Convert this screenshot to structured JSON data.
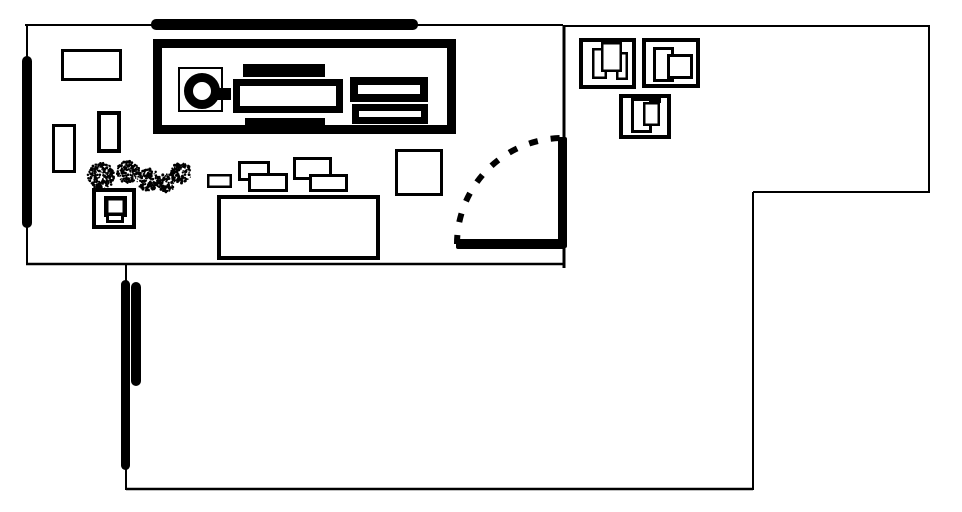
{
  "canvas": {
    "width": 962,
    "height": 512,
    "background": "#ffffff",
    "ink": "#000000"
  },
  "floor_plan": {
    "description": "black-and-white hand-drawn office floor plan",
    "shapes": [
      {
        "type": "line",
        "name": "wall-top-left-room",
        "x1": 25,
        "y1": 25,
        "x2": 563,
        "y2": 25,
        "sw": 2
      },
      {
        "type": "line",
        "name": "wall-top-right-section",
        "x1": 563,
        "y1": 26,
        "x2": 930,
        "y2": 26,
        "sw": 2
      },
      {
        "type": "line",
        "name": "wall-right-outer",
        "x1": 929,
        "y1": 25,
        "x2": 929,
        "y2": 193,
        "sw": 2
      },
      {
        "type": "line",
        "name": "wall-step",
        "x1": 753,
        "y1": 192,
        "x2": 929,
        "y2": 192,
        "sw": 2
      },
      {
        "type": "line",
        "name": "wall-lower-right",
        "x1": 753,
        "y1": 192,
        "x2": 753,
        "y2": 490,
        "sw": 2
      },
      {
        "type": "line",
        "name": "wall-bottom",
        "x1": 126,
        "y1": 489,
        "x2": 753,
        "y2": 489,
        "sw": 2.5
      },
      {
        "type": "line",
        "name": "wall-lower-left",
        "x1": 126,
        "y1": 264,
        "x2": 126,
        "y2": 490,
        "sw": 2
      },
      {
        "type": "line",
        "name": "wall-top-room-bottom",
        "x1": 26,
        "y1": 264,
        "x2": 563,
        "y2": 264,
        "sw": 2.5
      },
      {
        "type": "line",
        "name": "wall-left-outer",
        "x1": 27,
        "y1": 24,
        "x2": 27,
        "y2": 264,
        "sw": 2
      },
      {
        "type": "line",
        "name": "wall-divider-upper",
        "x1": 564,
        "y1": 26,
        "x2": 564,
        "y2": 140,
        "sw": 3
      },
      {
        "type": "line",
        "name": "wall-divider-lower",
        "x1": 564,
        "y1": 245,
        "x2": 564,
        "y2": 268,
        "sw": 3
      },
      {
        "type": "bar",
        "name": "wall-thick-top",
        "x": 151,
        "y": 19,
        "w": 267,
        "h": 11,
        "rx": 5
      },
      {
        "type": "bar",
        "name": "wall-thick-left",
        "x": 22,
        "y": 56,
        "w": 10,
        "h": 172,
        "rx": 5
      },
      {
        "type": "bar",
        "name": "door-leaf",
        "x": 558,
        "y": 137,
        "w": 9,
        "h": 111,
        "rx": 2
      },
      {
        "type": "bar",
        "name": "wall-thick-door-bottom",
        "x": 456,
        "y": 239,
        "w": 109,
        "h": 10,
        "rx": 2
      },
      {
        "type": "bar",
        "name": "partition-stroke-long",
        "x": 121,
        "y": 280,
        "w": 9,
        "h": 190,
        "rx": 4.5
      },
      {
        "type": "bar",
        "name": "partition-stroke-short",
        "x": 131,
        "y": 282,
        "w": 10,
        "h": 104,
        "rx": 5
      },
      {
        "type": "rect",
        "name": "machine-outer",
        "x": 153,
        "y": 39,
        "w": 303,
        "h": 95,
        "sw": 9
      },
      {
        "type": "rect",
        "name": "machine-tray",
        "x": 178,
        "y": 67,
        "w": 45,
        "h": 45,
        "sw": 2,
        "fill": "none"
      },
      {
        "type": "fill",
        "name": "machine-bar-top",
        "x": 243,
        "y": 64,
        "w": 82,
        "h": 13
      },
      {
        "type": "rect",
        "name": "machine-body",
        "x": 233,
        "y": 79,
        "w": 110,
        "h": 34,
        "sw": 7
      },
      {
        "type": "fill",
        "name": "machine-bar-bottom",
        "x": 245,
        "y": 118,
        "w": 80,
        "h": 13
      },
      {
        "type": "rect",
        "name": "machine-vent-upper",
        "x": 350,
        "y": 77,
        "w": 78,
        "h": 25,
        "sw": 8
      },
      {
        "type": "rect",
        "name": "machine-vent-lower",
        "x": 352,
        "y": 104,
        "w": 76,
        "h": 20,
        "sw": 7
      },
      {
        "type": "fill",
        "name": "machine-dial-stub",
        "x": 216,
        "y": 88,
        "w": 15,
        "h": 12
      },
      {
        "type": "circle",
        "name": "machine-dial",
        "cx": 202,
        "cy": 91,
        "r": 13.5,
        "sw": 9
      },
      {
        "type": "rect",
        "name": "shelf",
        "x": 61,
        "y": 49,
        "w": 61,
        "h": 32,
        "sw": 3
      },
      {
        "type": "rect",
        "name": "cabinet-left",
        "x": 52,
        "y": 124,
        "w": 24,
        "h": 49,
        "sw": 3
      },
      {
        "type": "rect",
        "name": "cabinet-mid",
        "x": 97,
        "y": 111,
        "w": 24,
        "h": 42,
        "sw": 4
      },
      {
        "type": "rect",
        "name": "chair-box",
        "x": 92,
        "y": 188,
        "w": 44,
        "h": 41,
        "sw": 4
      },
      {
        "type": "rect",
        "name": "chair-seat",
        "x": 104,
        "y": 196,
        "w": 23,
        "h": 21,
        "sw": 4.5
      },
      {
        "type": "rect",
        "name": "chair-base",
        "x": 106,
        "y": 213,
        "w": 18,
        "h": 10,
        "sw": 3
      },
      {
        "type": "rect",
        "name": "small-desk",
        "x": 207,
        "y": 174,
        "w": 25,
        "h": 14,
        "sw": 2.5
      },
      {
        "type": "rect",
        "name": "desk-a-top",
        "x": 238,
        "y": 161,
        "w": 32,
        "h": 20,
        "sw": 3
      },
      {
        "type": "rect",
        "name": "desk-a-front",
        "x": 248,
        "y": 173,
        "w": 40,
        "h": 19,
        "sw": 3
      },
      {
        "type": "rect",
        "name": "desk-b-top",
        "x": 293,
        "y": 157,
        "w": 39,
        "h": 23,
        "sw": 3
      },
      {
        "type": "rect",
        "name": "desk-b-front",
        "x": 309,
        "y": 174,
        "w": 39,
        "h": 18,
        "sw": 3
      },
      {
        "type": "rect",
        "name": "door-side-table",
        "x": 395,
        "y": 149,
        "w": 48,
        "h": 47,
        "sw": 3
      },
      {
        "type": "rect",
        "name": "work-table",
        "x": 217,
        "y": 195,
        "w": 163,
        "h": 65,
        "sw": 4
      },
      {
        "type": "rect",
        "name": "workstation-a-frame",
        "x": 579,
        "y": 38,
        "w": 57,
        "h": 51,
        "sw": 4
      },
      {
        "type": "rect",
        "name": "workstation-a-left",
        "x": 592,
        "y": 48,
        "w": 15,
        "h": 31,
        "sw": 2.5
      },
      {
        "type": "rect",
        "name": "workstation-a-right",
        "x": 616,
        "y": 52,
        "w": 12,
        "h": 28,
        "sw": 2.5
      },
      {
        "type": "rect",
        "name": "workstation-a-center",
        "x": 601,
        "y": 42,
        "w": 21,
        "h": 30,
        "sw": 2.5
      },
      {
        "type": "rect",
        "name": "workstation-b-frame",
        "x": 642,
        "y": 38,
        "w": 58,
        "h": 50,
        "sw": 4
      },
      {
        "type": "rect",
        "name": "workstation-b-left",
        "x": 653,
        "y": 47,
        "w": 21,
        "h": 35,
        "sw": 3
      },
      {
        "type": "rect",
        "name": "workstation-b-right",
        "x": 667,
        "y": 54,
        "w": 26,
        "h": 25,
        "sw": 3
      },
      {
        "type": "rect",
        "name": "workstation-c-frame",
        "x": 619,
        "y": 94,
        "w": 52,
        "h": 45,
        "sw": 4
      },
      {
        "type": "fill",
        "name": "workstation-c-notch",
        "x": 645,
        "y": 94,
        "w": 16,
        "h": 9
      },
      {
        "type": "rect",
        "name": "workstation-c-tall",
        "x": 631,
        "y": 98,
        "w": 21,
        "h": 35,
        "sw": 3
      },
      {
        "type": "rect",
        "name": "workstation-c-right",
        "x": 643,
        "y": 102,
        "w": 17,
        "h": 24,
        "sw": 2.5
      },
      {
        "type": "path",
        "name": "door-swing-arc",
        "d": "M 457 244 A 106 106 0 0 1 563 138",
        "sw": 6,
        "dash": "9 13"
      }
    ],
    "spray_blobs": [
      {
        "name": "plant-blob-1",
        "cx": 101,
        "cy": 176,
        "r": 13
      },
      {
        "name": "plant-blob-2",
        "cx": 128,
        "cy": 172,
        "r": 11
      },
      {
        "name": "plant-blob-3",
        "cx": 148,
        "cy": 180,
        "r": 11
      },
      {
        "name": "plant-blob-4",
        "cx": 166,
        "cy": 183,
        "r": 9
      },
      {
        "name": "plant-blob-5",
        "cx": 181,
        "cy": 173,
        "r": 10
      }
    ]
  }
}
